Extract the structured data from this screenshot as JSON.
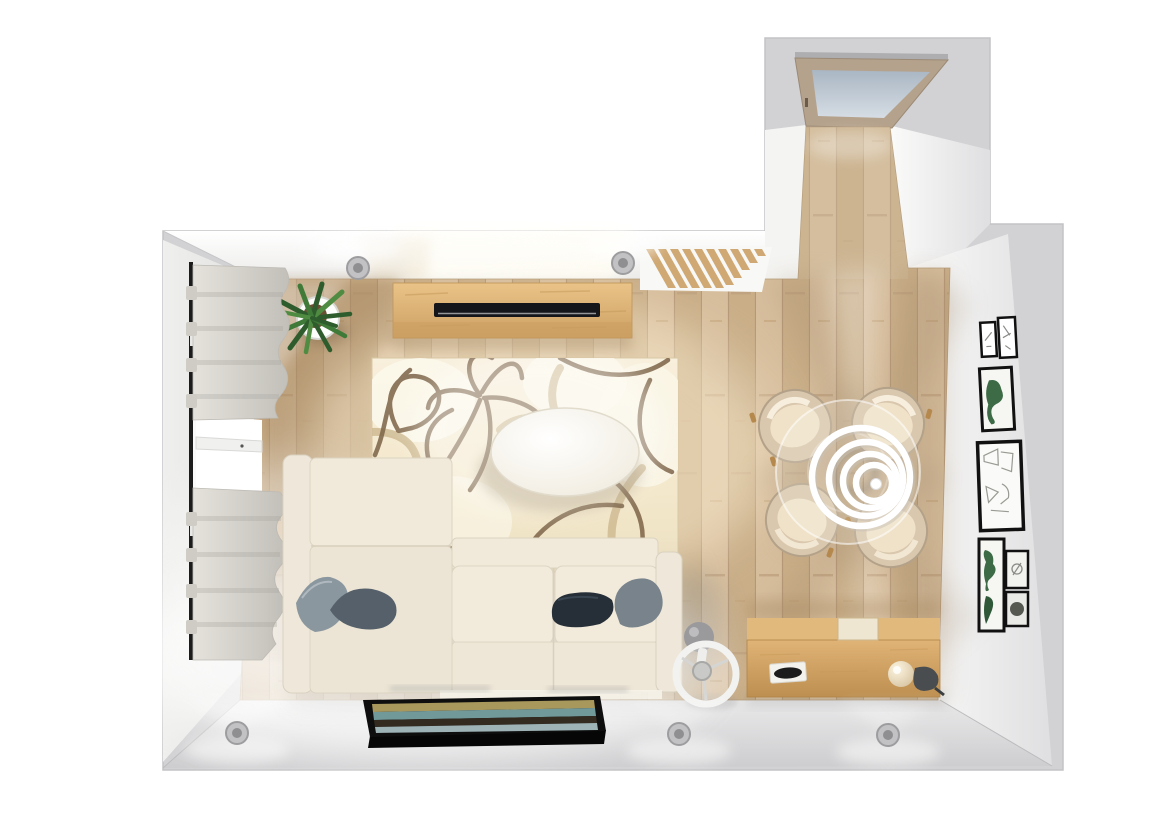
{
  "scene": {
    "type": "3d-room-planner-top-view",
    "room": "living-dining-room",
    "background": "#ffffff",
    "palette": {
      "wall_outer": "#d2d2d4",
      "wall_face_light": "#f7f7f5",
      "wall_face_shade": "#e4e4e6",
      "floor_oak": "#cfb693",
      "floor_oak_dark": "#a5865e",
      "rug_cream": "#f5ecd4",
      "rug_line_brown": "#7c6347",
      "rug_line_tan": "#cdb88f",
      "sofa_cream": "#f1eadb",
      "sofa_shade": "#ddd5c3",
      "pillow_slate": "#8b979f",
      "pillow_graphite": "#55606a",
      "pillow_charcoal": "#262f38",
      "pillow_gray": "#78838b",
      "table_white": "#fbfaf6",
      "oak_furniture": "#d9ad6e",
      "tv_black": "#14161a",
      "chair_shell": "#d9c7ae",
      "chair_seat": "#f0e2c8",
      "door_frame": "#b5a28c",
      "door_glass": "#bfcad4",
      "curtain_gray": "#d8d5cf",
      "plant_green": "#3f7a38",
      "pot_white": "#fdfdfb",
      "frame_black": "#111111",
      "art_green": "#3c6b45",
      "painting_olive": "#a8985c",
      "painting_teal": "#72999a",
      "painting_dark": "#332a20",
      "painting_bluegray": "#9eb3b6",
      "lamp_white": "#ffffff",
      "spotlight_gray": "#c2c2c4"
    },
    "objects": [
      {
        "id": "sofa",
        "label": "Cream fabric sofa with chaise and four cushions"
      },
      {
        "id": "rug",
        "label": "Cream rug with abstract brown line pattern"
      },
      {
        "id": "coffee-table",
        "label": "White oval coffee table"
      },
      {
        "id": "tv-sideboard",
        "label": "Oak TV sideboard with flat-screen TV"
      },
      {
        "id": "wall-radiator",
        "label": "Slatted wall radiator"
      },
      {
        "id": "plant",
        "label": "Potted green plant in white pot"
      },
      {
        "id": "window",
        "label": "Window with grey roman shades"
      },
      {
        "id": "dining-set",
        "label": "Round glass dining table with four cream tub chairs"
      },
      {
        "id": "pendant-lamp",
        "label": "White spiral pendant lamp"
      },
      {
        "id": "gallery-wall",
        "label": "Framed botanical and line-art prints"
      },
      {
        "id": "sideboard",
        "label": "Oak sideboard with decor objects"
      },
      {
        "id": "fan",
        "label": "White table fan"
      },
      {
        "id": "painting",
        "label": "Leaning abstract landscape painting"
      },
      {
        "id": "door",
        "label": "Wooden door with frosted glass panel"
      },
      {
        "id": "spotlights",
        "label": "Recessed ceiling spotlights"
      }
    ]
  }
}
